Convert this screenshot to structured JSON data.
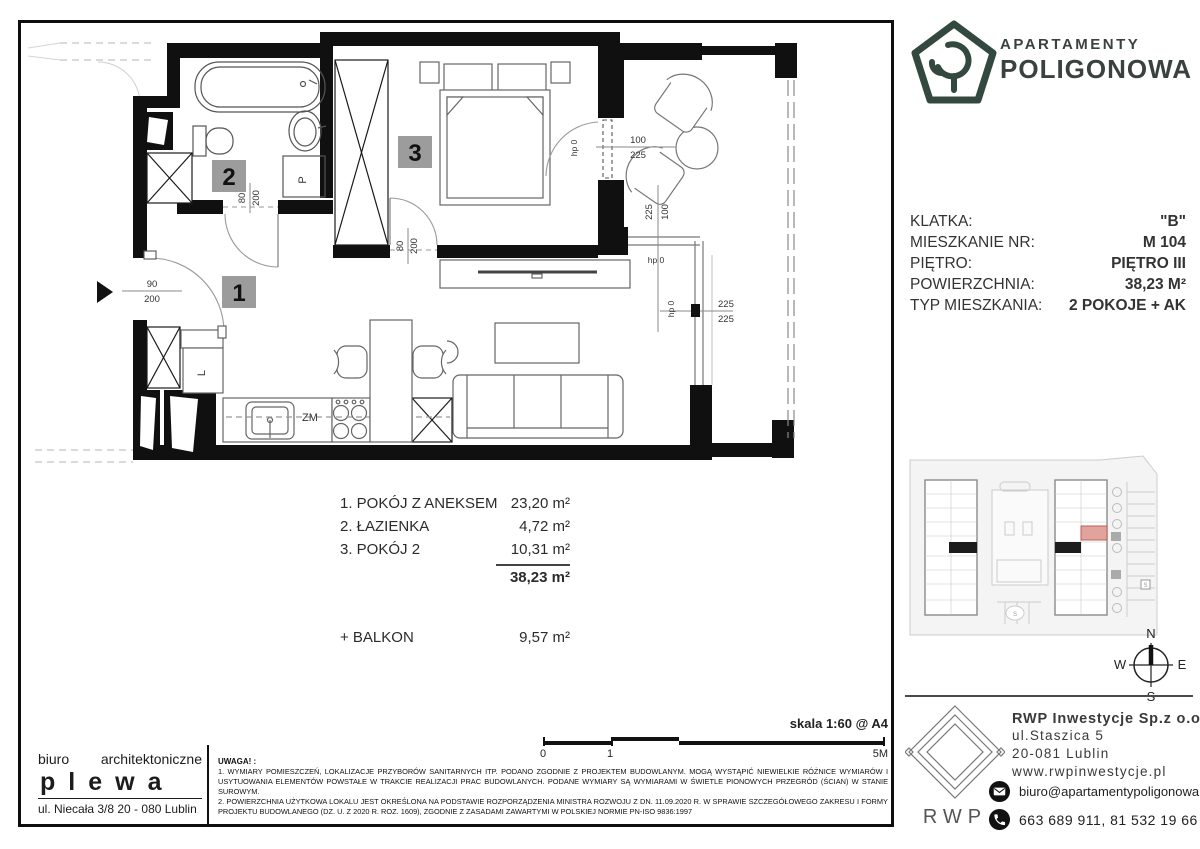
{
  "brand": {
    "line1": "APARTAMENTY",
    "line2": "POLIGONOWA",
    "logo_color": "#33493f"
  },
  "info": {
    "rows": [
      {
        "label": "KLATKA:",
        "value": "\"B\""
      },
      {
        "label": "MIESZKANIE NR:",
        "value": "M 104"
      },
      {
        "label": "PIĘTRO:",
        "value": "PIĘTRO III"
      },
      {
        "label": "POWIERZCHNIA:",
        "value": "38,23 M²"
      },
      {
        "label": "TYP MIESZKANIA:",
        "value": "2 POKOJE + AK"
      }
    ]
  },
  "rooms": {
    "items": [
      {
        "name": "1. POKÓJ Z ANEKSEM",
        "area": "23,20 m²"
      },
      {
        "name": "2. ŁAZIENKA",
        "area": "4,72 m²"
      },
      {
        "name": "3. POKÓJ 2",
        "area": "10,31 m²"
      }
    ],
    "total": "38,23 m²",
    "balcony_label": "+ BALKON",
    "balcony_area": "9,57 m²"
  },
  "plan": {
    "badge_1": "1",
    "badge_2": "2",
    "badge_3": "3",
    "label_fridge": "L",
    "label_washer": "P",
    "label_dishwasher": "ZM",
    "dim_entrance_top": "90",
    "dim_entrance_bottom": "200",
    "dim_bathdoor_a": "80",
    "dim_bathdoor_b": "200",
    "dim_room3door_a": "80",
    "dim_room3door_b": "200",
    "dim_balconydoor_top": "100",
    "dim_balconydoor_bottom": "225",
    "dim_side_a": "225",
    "dim_side_b": "100",
    "dim_window_a": "225",
    "dim_window_b": "225",
    "hp_label": "hp 0"
  },
  "scale": {
    "label": "skala 1:60 @ A4",
    "tick0": "0",
    "tick1": "1",
    "tick5": "5M"
  },
  "notes": {
    "title": "UWAGA! :",
    "p1": "1. WYMIARY POMIESZCZEŃ, LOKALIZACJE PRZYBORÓW SANITARNYCH ITP. PODANO ZGODNIE Z PROJEKTEM BUDOWLANYM. MOGĄ WYSTĄPIĆ NIEWIELKIE RÓŻNICE WYMIARÓW I USYTUOWANIA ELEMENTÓW POWSTAŁE W TRAKCIE REALIZACJI PRAC BUDOWLANYCH. PODANE WYMIARY SĄ WYMIARAMI W ŚWIETLE PIONOWYCH PRZEGRÓD (ŚCIAN) W STANIE SUROWYM.",
    "p2": "2. POWIERZCHNIA UŻYTKOWA LOKALU JEST OKREŚLONA NA PODSTAWIE ROZPORZĄDZENIA MINISTRA ROZWOJU Z DN. 11.09.2020 R. W SPRAWIE SZCZEGÓŁOWEGO ZAKRESU I FORMY PROJEKTU BUDOWLANEGO (DZ. U. Z 2020 R. ROZ. 1609), ZGODNIE Z ZASADAMI ZAWARTYMI W POLSKIEJ NORMIE PN-ISO 9836:1997"
  },
  "architect": {
    "word1": "biuro",
    "word2": "architektoniczne",
    "name": "plewa",
    "address": "ul. Niecała 3/8  20 - 080 Lublin"
  },
  "developer": {
    "logo_text": "RWP",
    "company": "RWP Inwestycje Sp.z o.o.",
    "street": "ul.Staszica 5",
    "city": "20-081 Lublin",
    "web": "www.rwpinwestycje.pl",
    "email": "biuro@apartamentypoligonowa.pl",
    "phones": "663 689 911,  81 532 19 66"
  },
  "compass": {
    "n": "N",
    "e": "E",
    "s": "S",
    "w": "W"
  }
}
